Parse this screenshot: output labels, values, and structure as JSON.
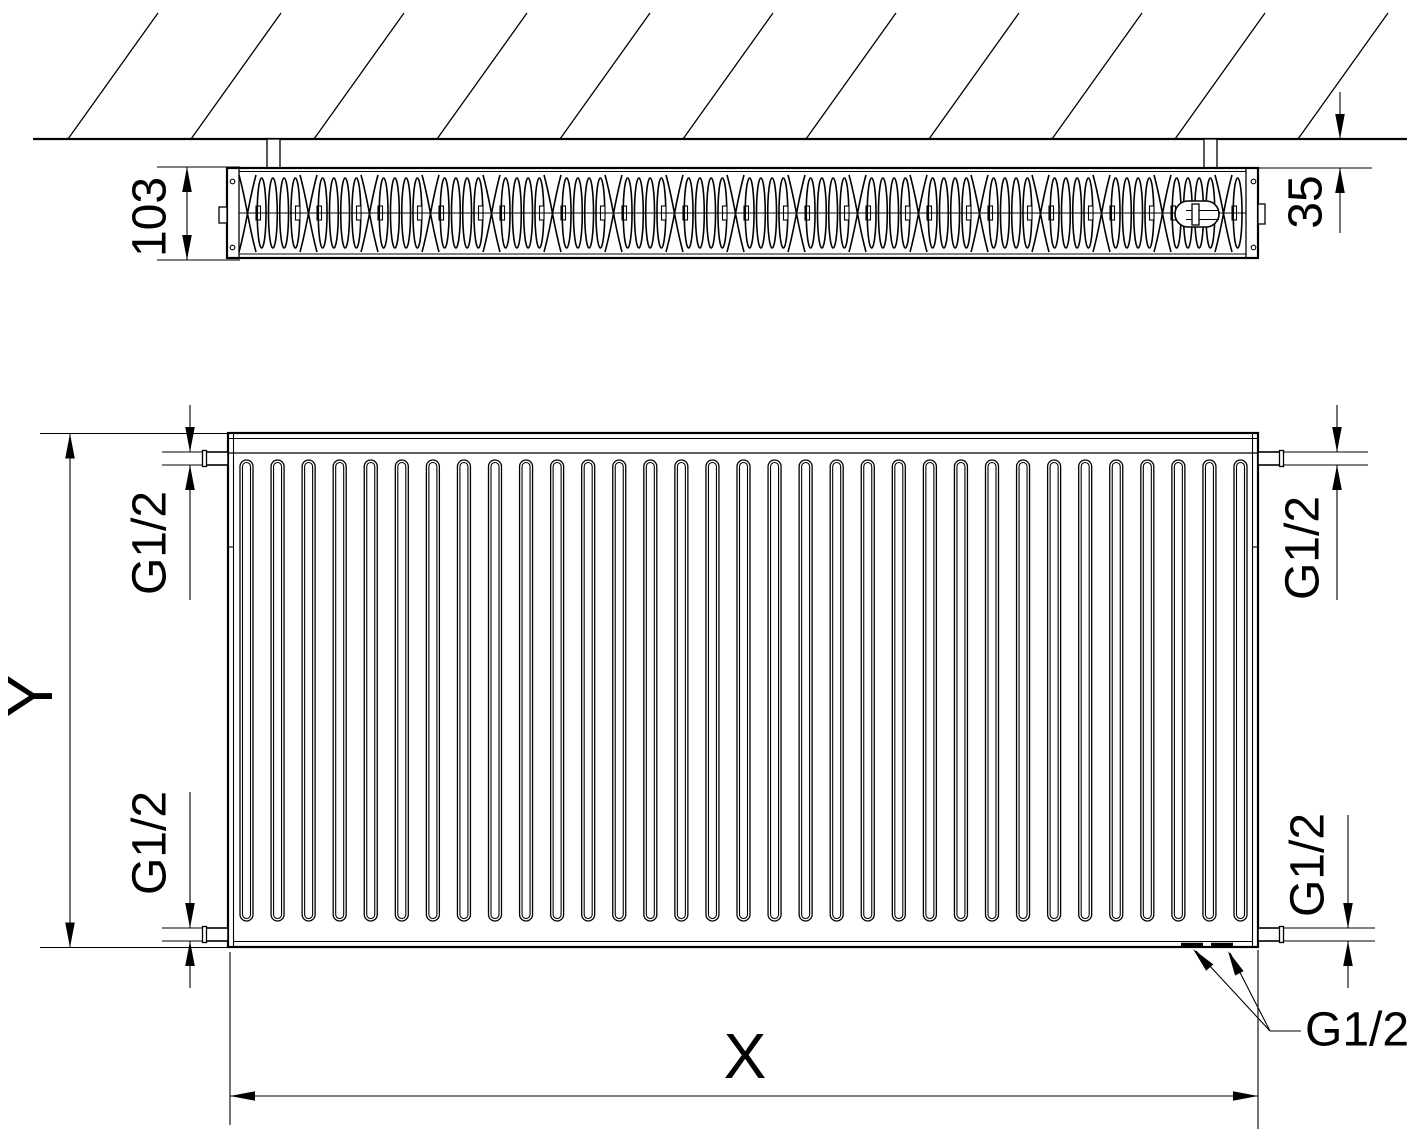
{
  "colors": {
    "line": "#000000",
    "background": "#ffffff"
  },
  "top_view": {
    "depth_label": "103",
    "wall_distance_label": "35"
  },
  "front_view": {
    "height_label": "Y",
    "width_label": "X",
    "connections": {
      "top_left": "G1/2",
      "top_right": "G1/2",
      "bottom_left": "G1/2",
      "bottom_right": "G1/2",
      "bottom_callout": "G1/2"
    }
  }
}
